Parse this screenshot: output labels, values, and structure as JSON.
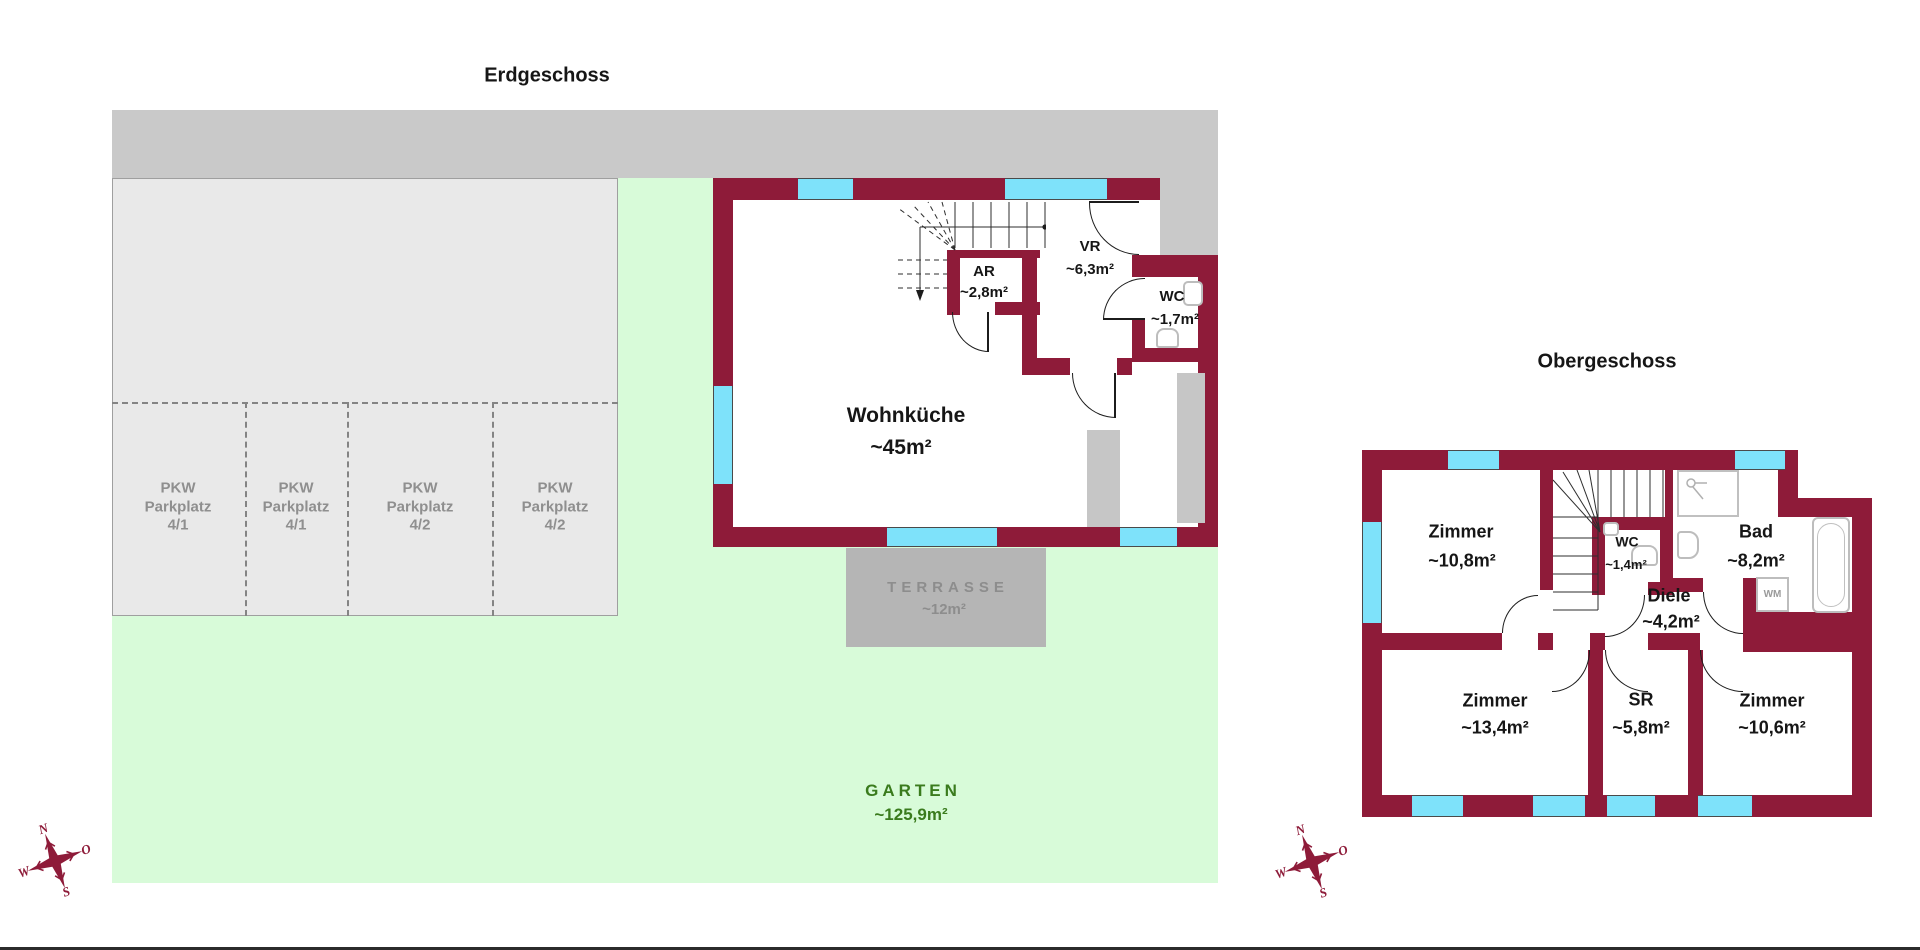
{
  "colors": {
    "wall": "#8e1b39",
    "window": "#7ee2fa",
    "street": "#c9c9c9",
    "parking_fill": "#e9e9e9",
    "parking_text": "#8f8f8f",
    "green": "#d8fbd9",
    "garten_text": "#3a7b1d",
    "terrasse_fill": "#b5b5b5",
    "terrasse_text": "#8d8d8d"
  },
  "floor1": {
    "title": "Erdgeschoss",
    "rooms": {
      "ar": {
        "name": "AR",
        "area": "~2,8m²"
      },
      "vr": {
        "name": "VR",
        "area": "~6,3m²"
      },
      "wc": {
        "name": "WC",
        "area": "~1,7m²"
      },
      "wohnkueche": {
        "name": "Wohnküche",
        "area": "~45m²"
      }
    },
    "terrasse": {
      "name": "TERRASSE",
      "area": "~12m²"
    },
    "garten": {
      "name": "GARTEN",
      "area": "~125,9m²"
    },
    "parking": {
      "spots": [
        {
          "line1": "PKW",
          "line2": "Parkplatz",
          "line3": "4/1"
        },
        {
          "line1": "PKW",
          "line2": "Parkplatz",
          "line3": "4/1"
        },
        {
          "line1": "PKW",
          "line2": "Parkplatz",
          "line3": "4/2"
        },
        {
          "line1": "PKW",
          "line2": "Parkplatz",
          "line3": "4/2"
        }
      ]
    }
  },
  "floor2": {
    "title": "Obergeschoss",
    "rooms": {
      "zimmer1": {
        "name": "Zimmer",
        "area": "~10,8m²"
      },
      "wc": {
        "name": "WC",
        "area": "~1,4m²"
      },
      "bad": {
        "name": "Bad",
        "area": "~8,2m²"
      },
      "diele": {
        "name": "Diele",
        "area": "~4,2m²"
      },
      "zimmer2": {
        "name": "Zimmer",
        "area": "~13,4m²"
      },
      "sr": {
        "name": "SR",
        "area": "~5,8m²"
      },
      "zimmer3": {
        "name": "Zimmer",
        "area": "~10,6m²"
      }
    },
    "labels": {
      "wm": "WM"
    }
  },
  "compass": {
    "n": "N",
    "o": "O",
    "s": "S",
    "w": "W"
  }
}
